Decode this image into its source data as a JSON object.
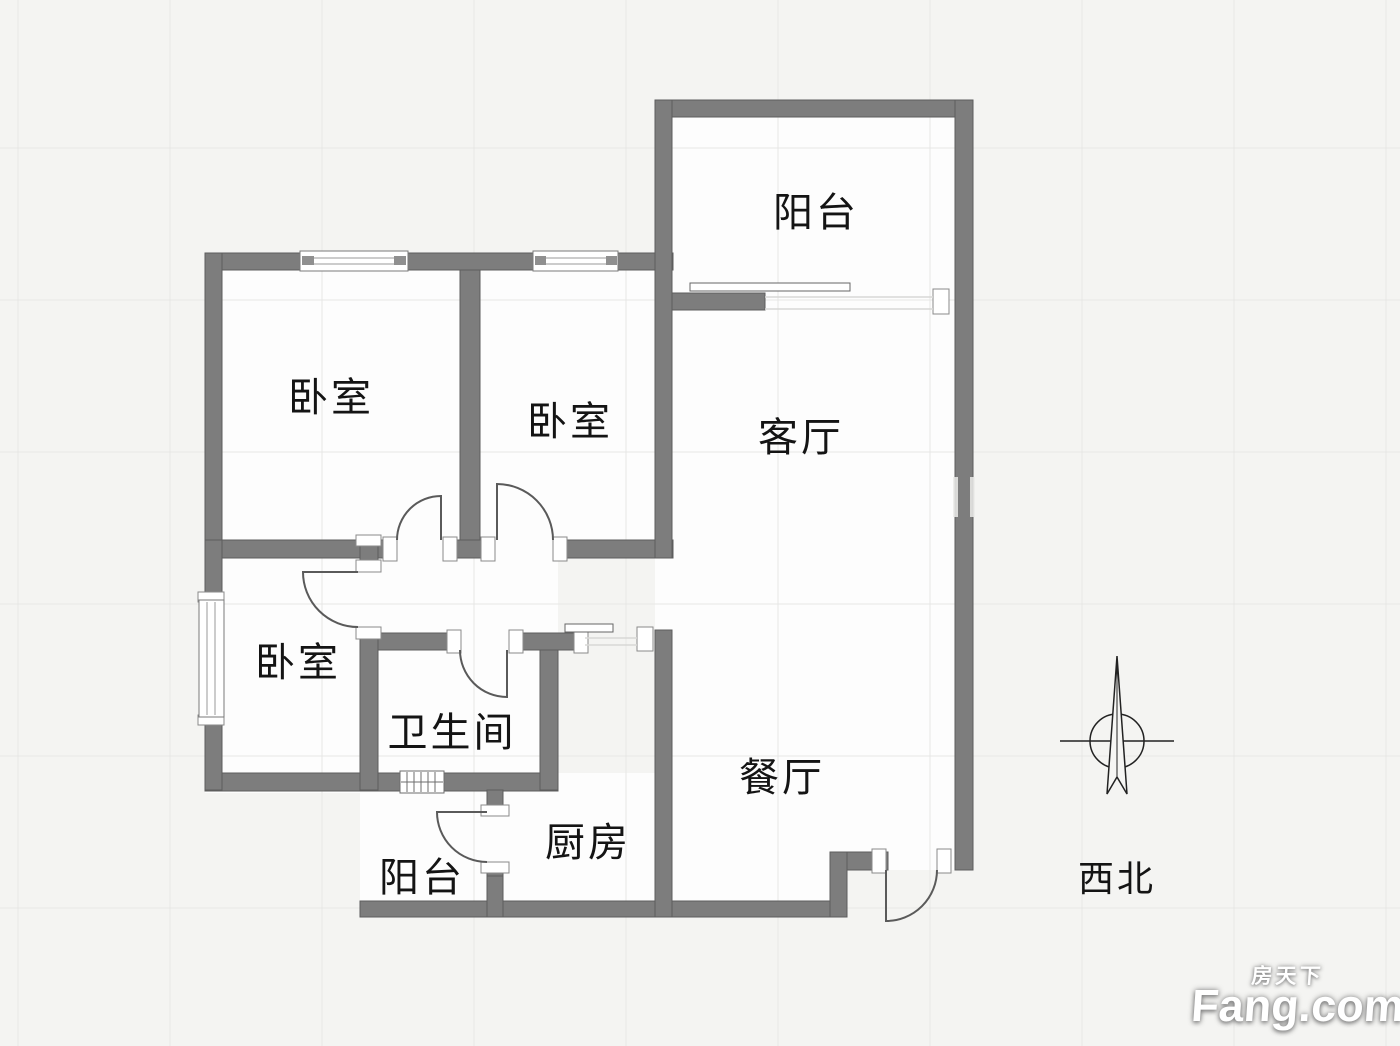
{
  "floorplan": {
    "rooms": [
      {
        "name": "balcony-top",
        "label": "阳台"
      },
      {
        "name": "bedroom-1",
        "label": "卧室"
      },
      {
        "name": "bedroom-2",
        "label": "卧室"
      },
      {
        "name": "living-room",
        "label": "客厅"
      },
      {
        "name": "bedroom-3",
        "label": "卧室"
      },
      {
        "name": "bathroom",
        "label": "卫生间"
      },
      {
        "name": "dining-room",
        "label": "餐厅"
      },
      {
        "name": "kitchen",
        "label": "厨房"
      },
      {
        "name": "balcony-bottom",
        "label": "阳台"
      }
    ],
    "compass": {
      "label": "西北"
    },
    "colors": {
      "wall": "#7d7d7d",
      "wall_edge": "#5d5d5d",
      "floor": "#fdfdfd",
      "background": "#f4f4f2",
      "text": "#141414"
    }
  },
  "watermark": {
    "cn": "房天下",
    "en": "Fang.com"
  }
}
